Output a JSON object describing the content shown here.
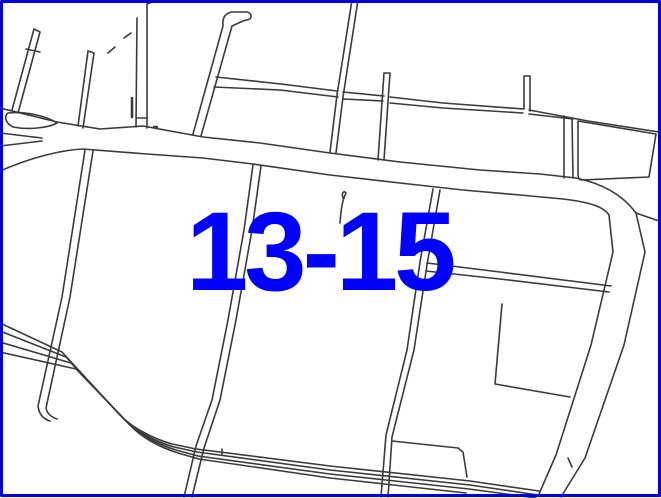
{
  "map": {
    "type": "cadastral-parcel-map",
    "parcel_label": {
      "text": "13-15"
    },
    "colors": {
      "background": "#ffffff",
      "line": "#3b3b3b",
      "frame_border": "#0000dd",
      "label": "#0000fe"
    },
    "features": [
      "frame-border",
      "main-road",
      "road-fork-island",
      "northwest-lane-a",
      "northwest-lane-b",
      "vertical-street-top-left",
      "hooked-street-top-center",
      "narrow-lane-east-west",
      "vertical-street-top-right",
      "parcel-stub-lanes",
      "right-parcel-block",
      "parcel-lane-a",
      "parcel-lane-b",
      "parcel-lane-c",
      "horizontal-lane-right",
      "l-shaped-boundary",
      "step-parcel-boundary",
      "multitrack-highway-bottom",
      "right-side-road",
      "pigtail-survey-mark",
      "parcel-number-label"
    ]
  }
}
